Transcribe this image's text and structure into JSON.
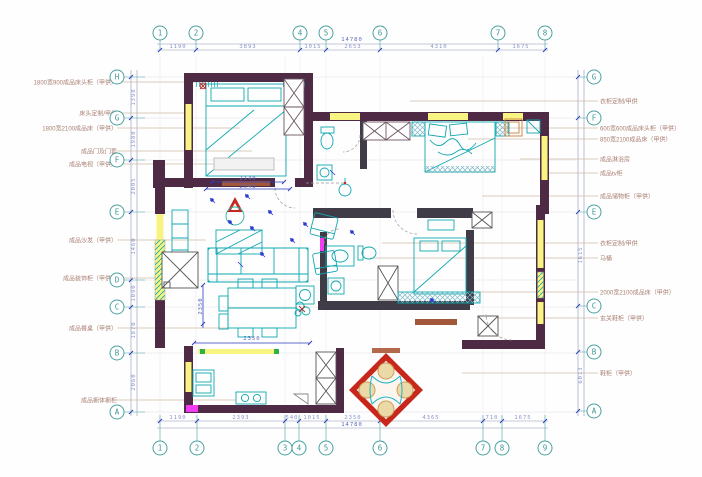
{
  "grid": {
    "top": [
      {
        "label": "1"
      },
      {
        "label": "2"
      },
      {
        "label": "4"
      },
      {
        "label": "5"
      },
      {
        "label": "6"
      },
      {
        "label": "7"
      },
      {
        "label": "8"
      }
    ],
    "bottom": [
      {
        "label": "1"
      },
      {
        "label": "2"
      },
      {
        "label": "3"
      },
      {
        "label": "4"
      },
      {
        "label": "5"
      },
      {
        "label": "6"
      },
      {
        "label": "7"
      },
      {
        "label": "8"
      },
      {
        "label": "9"
      }
    ],
    "left": [
      {
        "label": "H"
      },
      {
        "label": "G"
      },
      {
        "label": "F"
      },
      {
        "label": "E"
      },
      {
        "label": "D"
      },
      {
        "label": "C"
      },
      {
        "label": "B"
      },
      {
        "label": "A"
      }
    ],
    "right": [
      {
        "label": "G"
      },
      {
        "label": "F"
      },
      {
        "label": "E"
      },
      {
        "label": "C"
      },
      {
        "label": "B"
      },
      {
        "label": "A"
      }
    ]
  },
  "dimensions": {
    "top": {
      "total": "14780",
      "segments": [
        "1190",
        "3893",
        "1015",
        "2653",
        "4310",
        "1675"
      ]
    },
    "bottom": {
      "total": "14780",
      "segments": [
        "1190",
        "2393",
        "540",
        "1015",
        "2350",
        "4365",
        "710",
        "1675"
      ]
    },
    "left": {
      "segments": [
        "1398",
        "1980",
        "2005",
        "1460",
        "1090",
        "1870",
        "2060"
      ]
    },
    "right": {
      "segments": [
        "1615",
        "6013"
      ]
    },
    "interior": {
      "master_width": "2948",
      "master_inner": "2140",
      "kitchen_width": "2350",
      "kitchen_height": "2350"
    }
  },
  "annotations": {
    "left": [
      {
        "text": "1800宽900成品床头柜（甲供）"
      },
      {
        "text": "床头定制/甲供"
      },
      {
        "text": "1800宽2100成品床（甲供）"
      },
      {
        "text": "成品门及门套"
      },
      {
        "text": "成品电视（甲供）"
      },
      {
        "text": "成品沙发（甲供）"
      },
      {
        "text": "成品装饰柜（甲供）"
      },
      {
        "text": "成品餐桌（甲供）"
      },
      {
        "text": "成品橱体橱柜"
      }
    ],
    "right": [
      {
        "text": "衣柜定制/甲供"
      },
      {
        "text": "600宽600成品床头柜（甲供）"
      },
      {
        "text": "850宽2100成品床（甲供）"
      },
      {
        "text": "成品淋浴房"
      },
      {
        "text": "成品tv柜"
      },
      {
        "text": "成品储物柜（甲供）"
      },
      {
        "text": "衣柜定制/甲供"
      },
      {
        "text": "马桶"
      },
      {
        "text": "2000宽2100成品床（甲供）"
      },
      {
        "text": "玄关鞋柜（甲供）"
      },
      {
        "text": "鞋柜（甲供）"
      }
    ]
  },
  "colors": {
    "wall": "#4e2a45",
    "partition": "#3f3b47",
    "insulation_yellow": "#f8f482",
    "furniture_cyan": "#0fa8b0",
    "dimension_blue": "#2d3ec0",
    "axis_teal": "#49a0a0",
    "annotation": "#a97f72",
    "accent_red": "#c8281c",
    "door_magenta": "#f23bf2",
    "marker_green": "#2db04a",
    "chair_tan": "#ecd9a8"
  }
}
